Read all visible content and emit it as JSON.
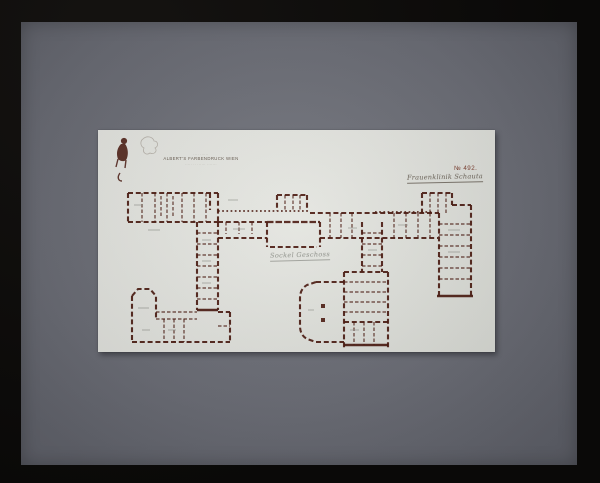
{
  "colors": {
    "frame": "#0a0908",
    "mat": "#6d6f78",
    "paper": "#e5e6e1",
    "ink": "#4b1a10",
    "number": "#7d4031",
    "hand": "#6b6358",
    "pencil": "#9a9c95",
    "stamp": "#675c51"
  },
  "stamp": {
    "top_line": "····  ······",
    "main_line": "ALBERT'S FARBENDRUCK WIEN",
    "bottom_line": "····· ·· ······ ·······"
  },
  "labels": {
    "plate_number": "№ 492.",
    "title": "Frauenklinik Schauta",
    "floor": "Sockel Geschoss"
  }
}
